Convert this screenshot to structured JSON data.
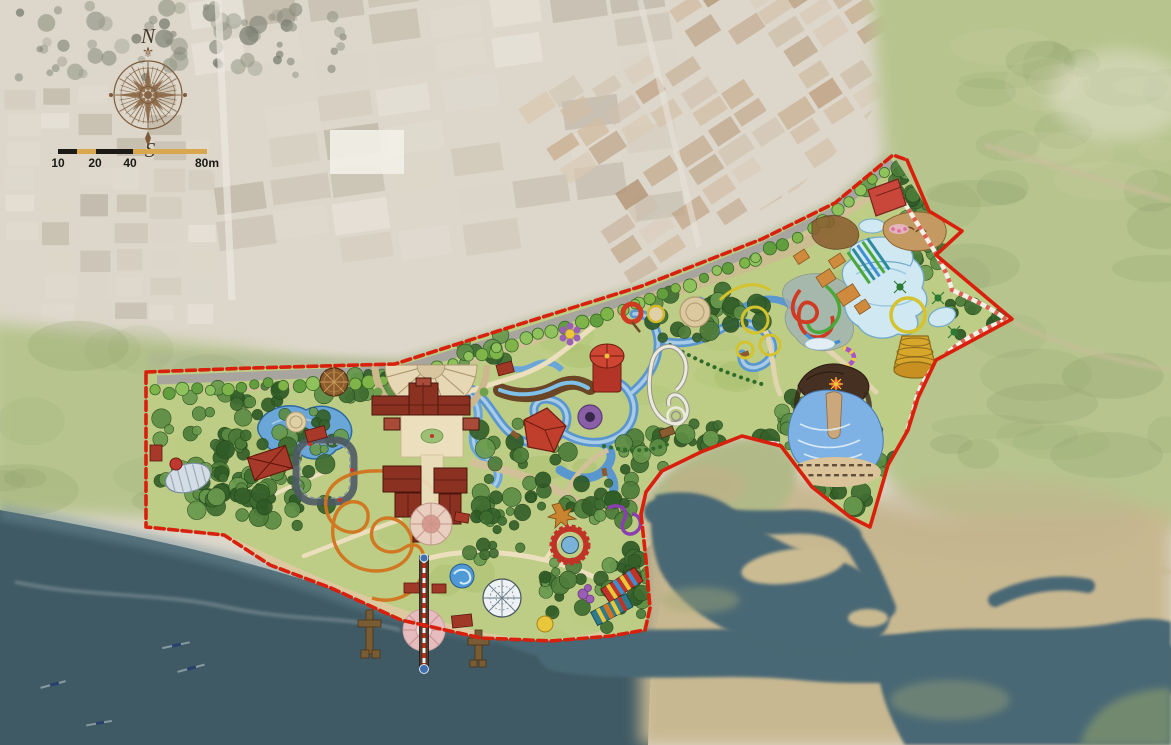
{
  "compass": {
    "north_label": "N",
    "south_label": "S",
    "fleur_icon": "⚜"
  },
  "scale_bar": {
    "tick_labels": [
      "10",
      "20",
      "40",
      "80m"
    ],
    "bar_dark": "#1c1a17",
    "bar_tan": "#d9a84e"
  },
  "colors": {
    "boundary_red": "#d8200c",
    "sea": "#3f5a64",
    "estuary_channel": "#4a6774",
    "field_green": "#b7c48e",
    "park_green": "#bdcd85",
    "industrial_beige": "#ddd7cb",
    "road_gray": "#a8a49e",
    "lake_blue": "#6aa7d8",
    "pool_blue": "#cfe8f2",
    "roof_red": "#8a3122",
    "path_cream": "#ecdfbd",
    "sand_tan": "#c8b890",
    "gold": "#d9a62c",
    "coaster_orange": "#d2731e",
    "compass_sepia": "#7d5a3a"
  }
}
